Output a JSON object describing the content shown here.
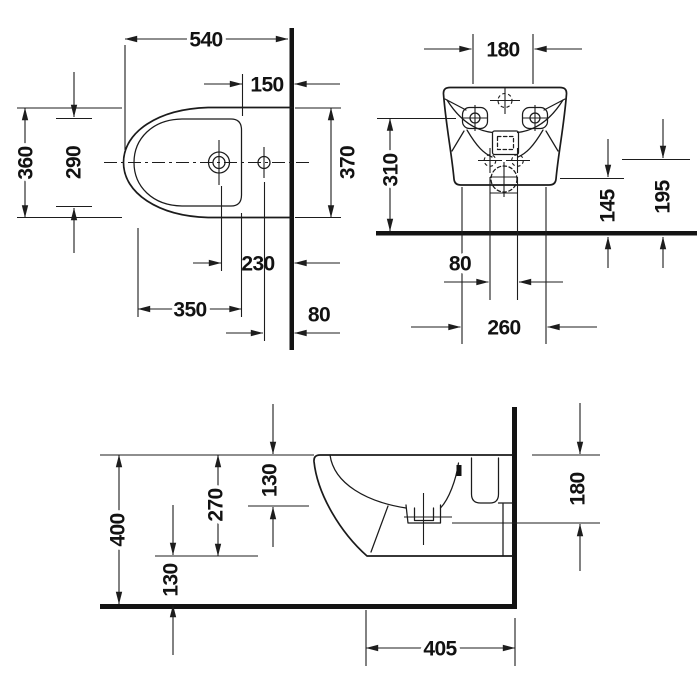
{
  "views": {
    "plan": {
      "dims": {
        "overall_length": "540",
        "rim_to_wall": "150",
        "overall_width": "360",
        "basin_width": "290",
        "wall_side_width": "370",
        "tap_to_wall": "230",
        "basin_length": "350",
        "supply_hole_to_wall": "80"
      }
    },
    "front": {
      "dims": {
        "tap_deck_width": "180",
        "fixing_hole_height": "310",
        "drain_center_height": "145",
        "outlet_height": "195",
        "outlet_spacing": "80",
        "fixing_spacing": "260"
      }
    },
    "side": {
      "dims": {
        "rim_to_basin_depth": "130",
        "rim_to_underside": "270",
        "rim_height": "400",
        "floor_clearance": "130",
        "rim_to_outlet": "180",
        "projection": "405"
      }
    }
  }
}
